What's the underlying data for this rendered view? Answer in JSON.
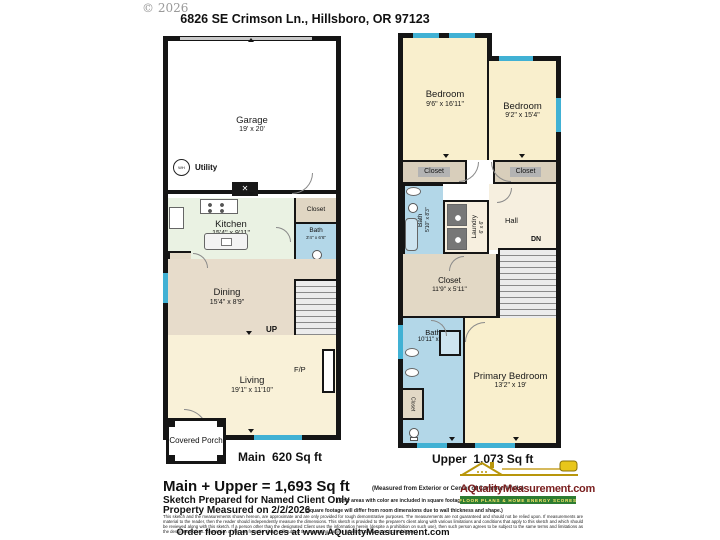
{
  "header": {
    "copyright": "© 2026",
    "address": "6826 SE Crimson Ln., Hillsboro, OR 97123"
  },
  "main_floor": {
    "label": "Main  620 Sq ft",
    "garage": {
      "name": "Garage",
      "dims": "19' x 20'"
    },
    "utility_label": "Utility",
    "wh_label": "WH",
    "kitchen": {
      "name": "Kitchen",
      "dims": "15'4\" x 9'11\""
    },
    "closet_label": "Closet",
    "bath": {
      "name": "Bath",
      "dims": "3'4\" x 6'6\""
    },
    "pantry_label": "Pantry",
    "dining": {
      "name": "Dining",
      "dims": "15'4\" x 8'9\""
    },
    "up_label": "UP",
    "living": {
      "name": "Living",
      "dims": "19'1\" x 11'10\""
    },
    "fp_label": "F/P",
    "porch_label": "Covered Porch"
  },
  "upper_floor": {
    "label": "Upper  1,073 Sq ft",
    "bedroom_left": {
      "name": "Bedroom",
      "dims": "9'6\" x 16'11\""
    },
    "bedroom_right": {
      "name": "Bedroom",
      "dims": "9'2\" x 15'4\""
    },
    "closet_left_label": "Closet",
    "closet_right_label": "Closet",
    "bath_hall": {
      "name": "Bath",
      "dims": "5'10\" x 8'3\""
    },
    "laundry": {
      "name": "Laundry",
      "dims": "6' x 6'"
    },
    "closet_side_label": "Closet",
    "hall_label": "Hall",
    "dn_label": "DN",
    "closet_walkin": {
      "name": "Closet",
      "dims": "11'9\" x 5'11\""
    },
    "bath_primary": {
      "name": "Bath",
      "dims": "10'11\" x 19'"
    },
    "closet_small_label": "Closet",
    "primary_bedroom": {
      "name": "Primary Bedroom",
      "dims": "13'2\" x 19'"
    }
  },
  "footer": {
    "total": "Main + Upper = 1,693 Sq ft",
    "total_note": "(Measured from Exterior or Center of Common Walls)",
    "prepared_line": "Sketch Prepared for Named Client Only",
    "prepared_note": "(Only areas with color are included in square footage totals.)",
    "measured_line": "Property Measured on 2/2/2026",
    "measured_note": "(Square footage will differ from room dimensions due to wall thickness and shape.)",
    "disclaimer": "This sketch and the measurements shown hereon, are approximate and are only provided for rough demonstrative purposes. The measurements are not guaranteed and should not be relied upon. If measurements are material to the reader, then the reader should independently measure the dimensions. This sketch is provided to the preparer's client along with various limitations and conditions that apply to this sketch and which should be reviewed along with this sketch. If a person other than the designated Client uses the information herein (despite a prohibition on such use), then such person agrees to be subject to the same terms and limitations as the designated Client. Separation of this text from the sketch will subject the separating party to liability.  (Quality Control Check by DK)",
    "order_line": "Order floor plan services at www.AQualityMeasurement.com"
  },
  "logo": {
    "brand": "AQualityMeasurement.com",
    "tagline": "FLOOR PLANS & HOME ENERGY SCORES"
  },
  "colors": {
    "wall": "#151515",
    "window": "#41b1d4",
    "bath_blue": "#b3d7e8",
    "room_cream": "#f9efcd",
    "living_cream": "#f9f1d8",
    "dining_tan": "#e7dccb",
    "kitchen_green": "#eaf2e3",
    "closet_tan": "#e0d6c3",
    "brand_red": "#7a1f1f",
    "brand_green": "#2e7d32"
  }
}
